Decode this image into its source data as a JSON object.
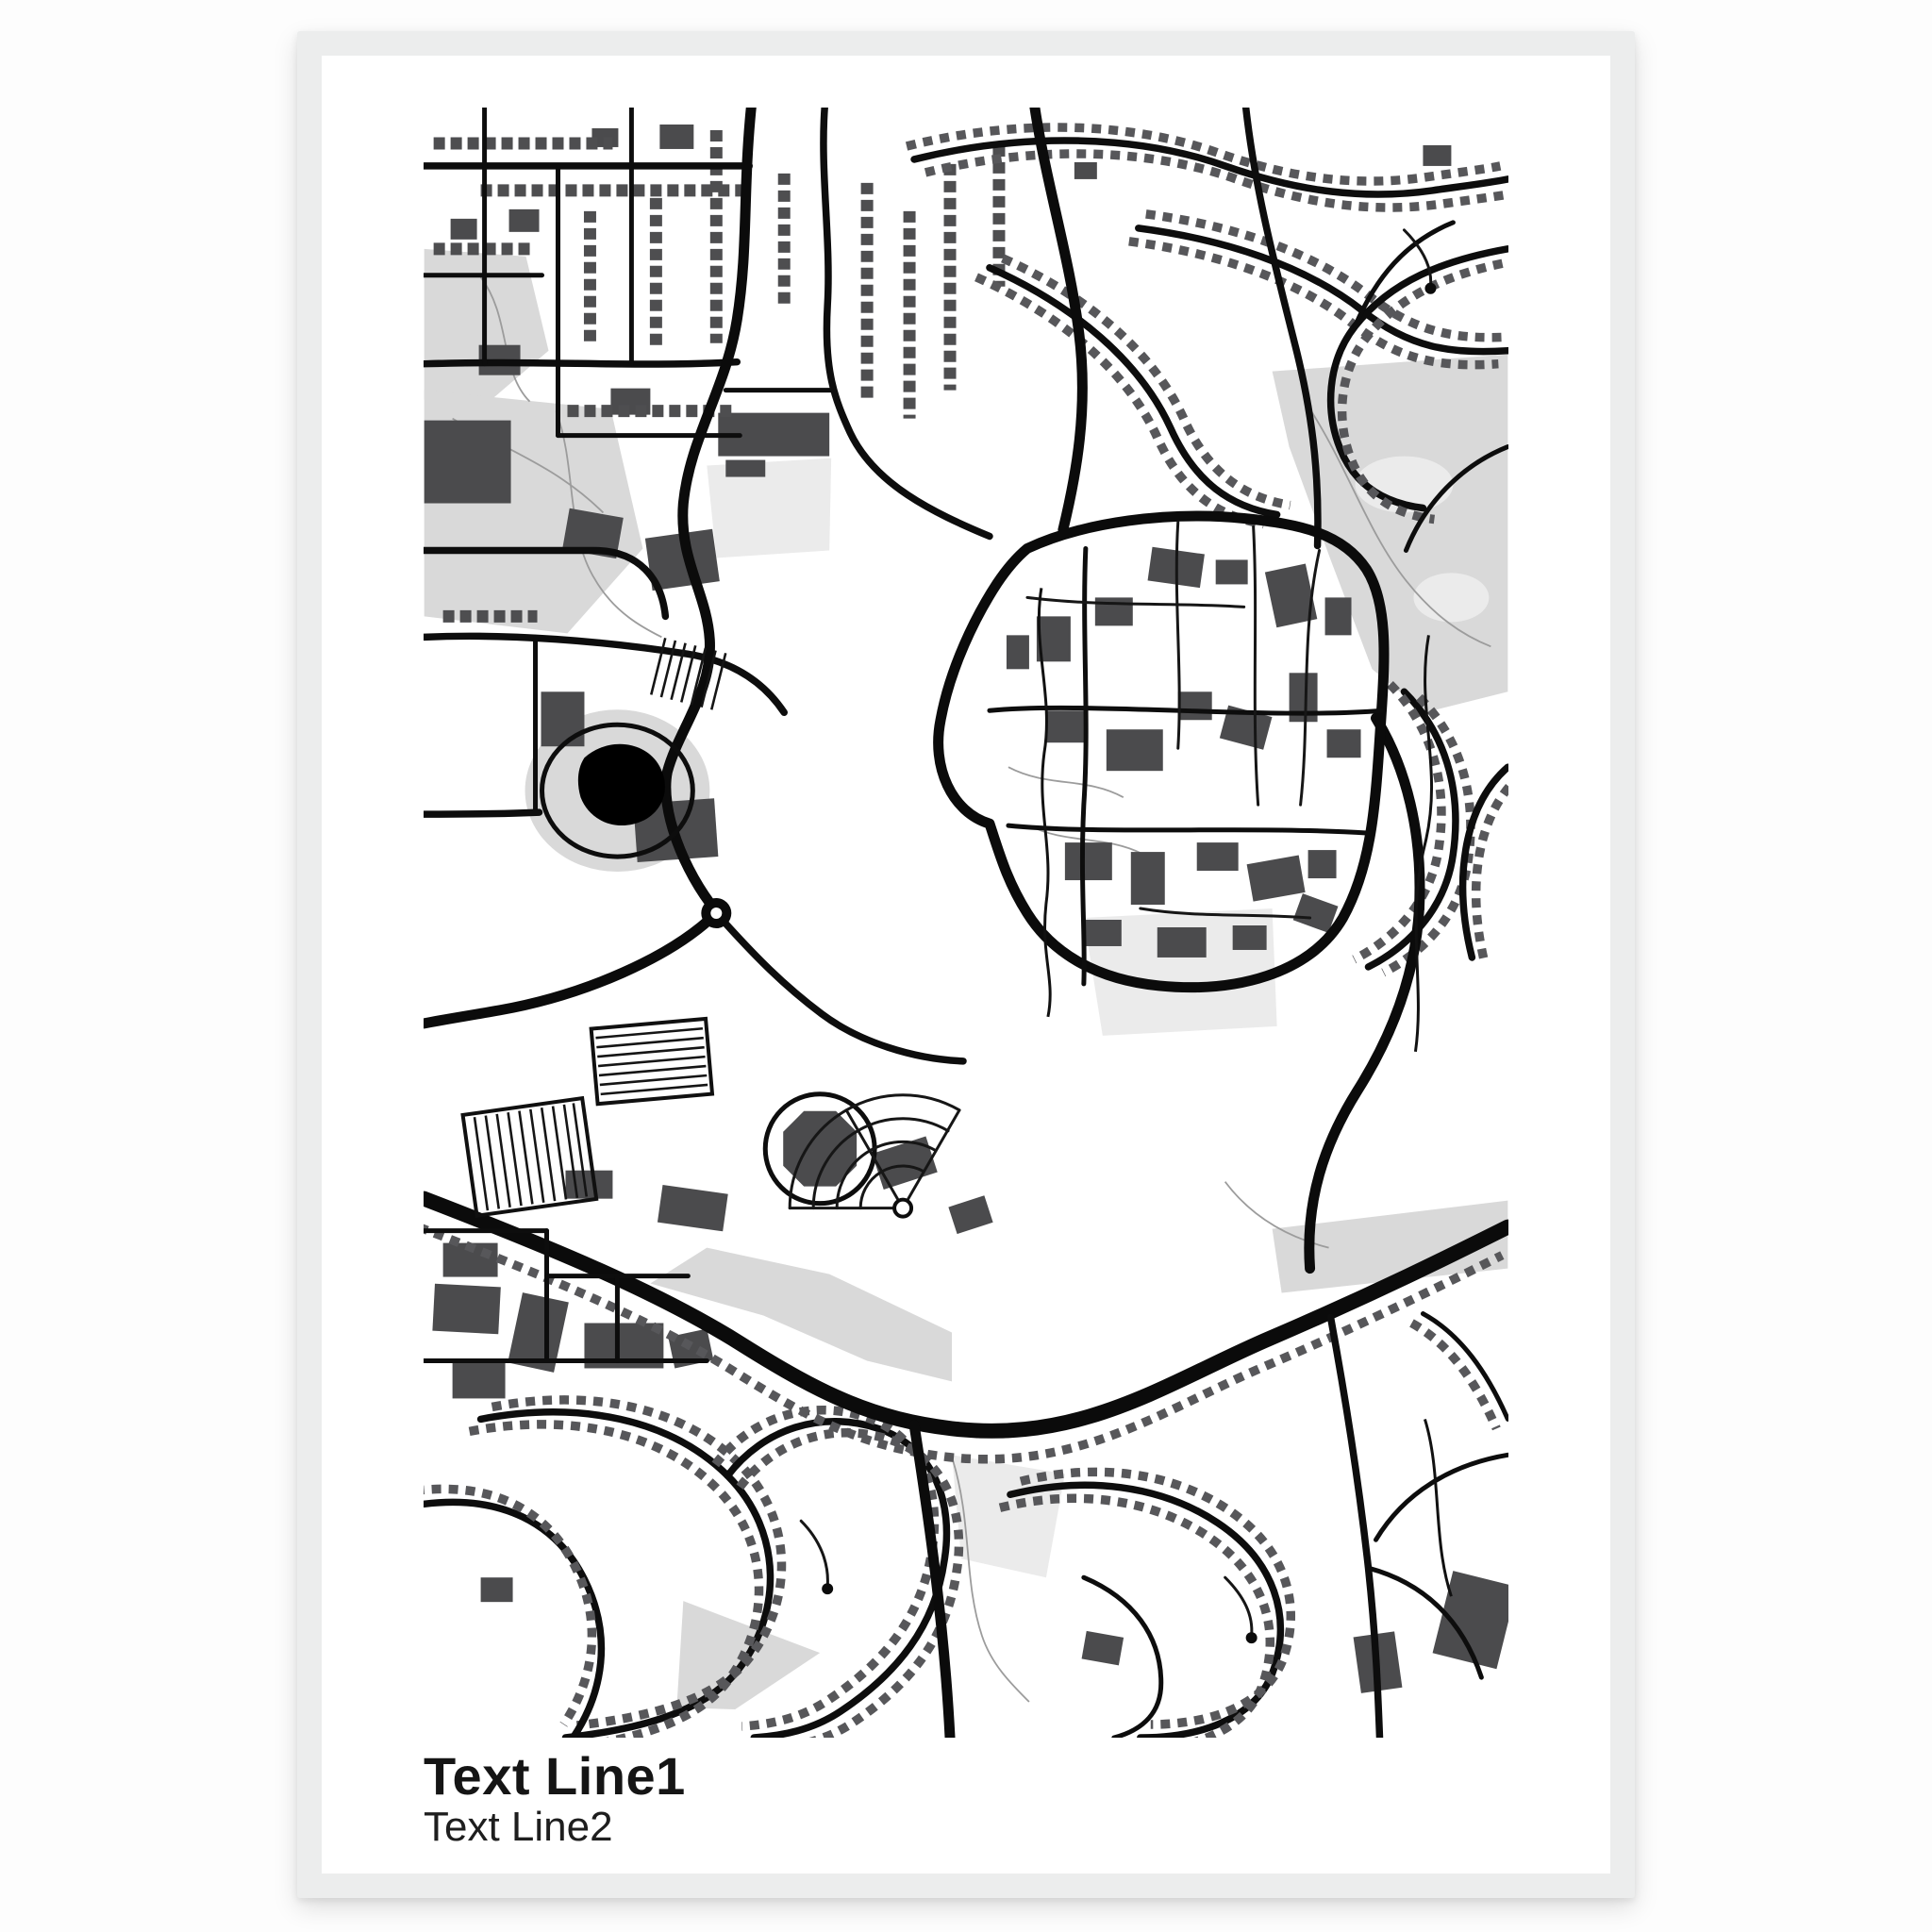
{
  "poster": {
    "text_line1": "Text Line1",
    "text_line2": "Text Line2"
  },
  "style": {
    "background_color": "#fdfdfd",
    "frame_color": "#eceded",
    "paper_color": "#ffffff",
    "road_color": "#0b0b0b",
    "building_color": "#4b4b4d",
    "house_row_color": "#57575a",
    "park_color": "#d9d9d9",
    "water_color": "#000000",
    "title_color": "#151515"
  },
  "map": {
    "kind": "monochrome-street-map-poster",
    "landmarks": [
      "central-campus-ring-road",
      "pond-with-park-oval",
      "stadium-octagon",
      "radial-fan-streets",
      "parking-lot-grids",
      "suburban-house-rows",
      "diagonal-highway",
      "golf-course-green",
      "roundabout"
    ]
  }
}
